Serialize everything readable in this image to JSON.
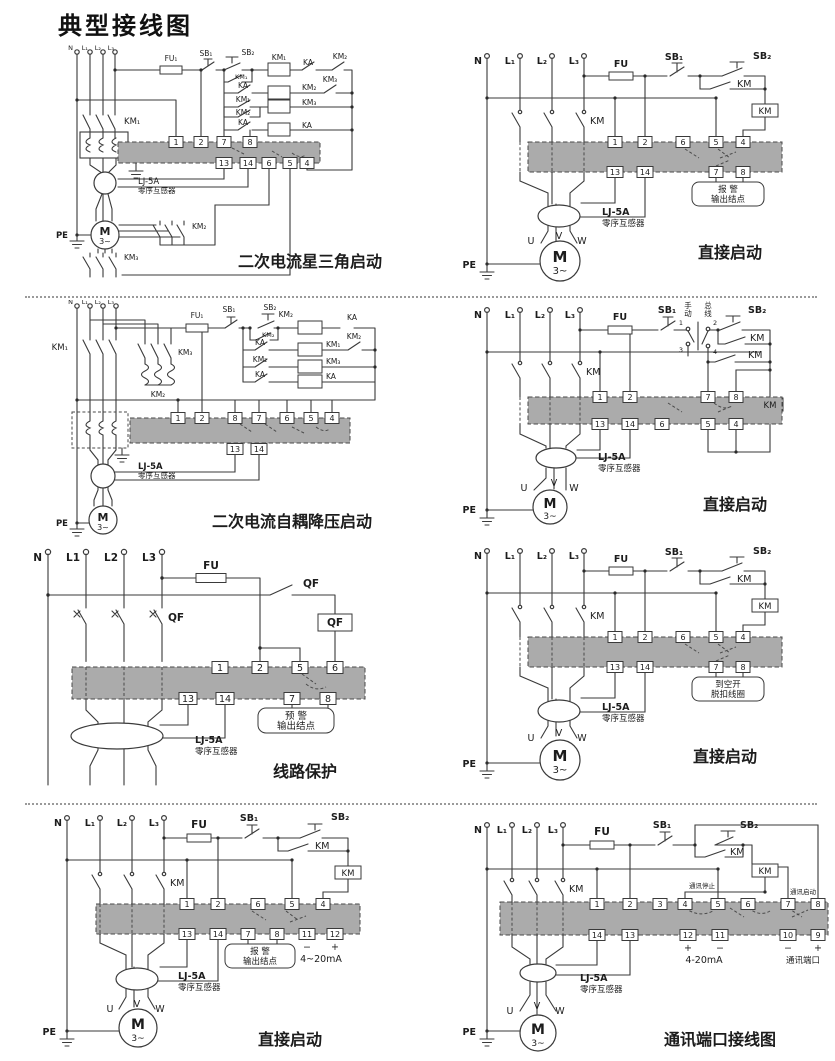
{
  "title": "典型接线图",
  "colors": {
    "relay_block": "#ababab",
    "wire": "#3a3a3a"
  },
  "d0": {
    "caption": "二次电流星三角启动",
    "n": "N",
    "l1": "L₁",
    "l2": "L₂",
    "l3": "L₃",
    "fu": "FU₁",
    "sb1": "SB₁",
    "sb2": "SB₂",
    "km1_coil": "KM₁",
    "ka_nc": "KA",
    "km2_nc": "KM₂",
    "km1_hold": "KM₁",
    "ka_no": "KA",
    "km2_coil": "KM₂",
    "km3_nc": "KM₃",
    "km1_no": "KM₁",
    "km2_no": "KM₂",
    "km3_coil": "KM₃",
    "ka2": "KA",
    "ka_coil": "KA",
    "km_main": "KM₁",
    "km2_main": "KM₂",
    "km3_main": "KM₃",
    "t_top": [
      "1",
      "2",
      "7",
      "8"
    ],
    "t_bot": [
      "13",
      "14",
      "6",
      "5",
      "4"
    ],
    "ct_name": "LJ-5A",
    "ct_desc": "零序互感器",
    "pe": "PE",
    "motor": "M",
    "motor_sub": "3~"
  },
  "d1": {
    "caption": "直接启动",
    "n": "N",
    "l1": "L₁",
    "l2": "L₂",
    "l3": "L₃",
    "fu": "FU",
    "sb1": "SB₁",
    "sb2": "SB₂",
    "km_hold": "KM",
    "km_coil": "KM",
    "km_main": "KM",
    "t_top": [
      "1",
      "2",
      "6",
      "5",
      "4"
    ],
    "t_bot": [
      "13",
      "14",
      "7",
      "8"
    ],
    "out1": "报 警",
    "out2": "输出结点",
    "ct_name": "LJ-5A",
    "ct_desc": "零序互感器",
    "u": "U",
    "v": "V",
    "w": "W",
    "pe": "PE",
    "motor": "M",
    "motor_sub": "3~"
  },
  "d2": {
    "caption": "二次电流自耦降压启动",
    "n": "N",
    "l1": "L₁",
    "l2": "L₂",
    "l3": "L₃",
    "km1_main": "KM₁",
    "km3_main": "KM₃",
    "km2_auto": "KM₂",
    "fu": "FU₁",
    "sb1": "SB₁",
    "sb2": "SB₂",
    "km2_coil": "KM₂",
    "ka_nc": "KA",
    "km2_hold": "KM₂",
    "ka_no": "KA",
    "km1_coil": "KM₁",
    "km2_nc": "KM₂",
    "km2_no": "KM₂",
    "km3_coil": "KM₃",
    "ka2": "KA",
    "ka_coil": "KA",
    "t_top": [
      "1",
      "2",
      "8",
      "7",
      "6",
      "5",
      "4"
    ],
    "t_bot": [
      "13",
      "14"
    ],
    "ct_name": "LJ-5A",
    "ct_desc": "零序互感器",
    "pe": "PE",
    "motor": "M",
    "motor_sub": "3~"
  },
  "d3": {
    "caption": "直接启动",
    "n": "N",
    "l1": "L₁",
    "l2": "L₂",
    "l3": "L₃",
    "fu": "FU",
    "sb1": "SB₁",
    "sb2": "SB₂",
    "manual_1": "手",
    "manual_2": "动",
    "bus_1": "总",
    "bus_2": "线",
    "s1": "1",
    "s3": "3",
    "s2": "2",
    "s4": "4",
    "km_hold": "KM",
    "km_no": "KM",
    "km_coil": "KM",
    "km_main": "KM",
    "t_top": [
      "1",
      "2",
      "7",
      "8"
    ],
    "t_bot": [
      "13",
      "14",
      "6",
      "5",
      "4"
    ],
    "ct_name": "LJ-5A",
    "ct_desc": "零序互感器",
    "u": "U",
    "v": "V",
    "w": "W",
    "pe": "PE",
    "motor": "M",
    "motor_sub": "3~"
  },
  "d4": {
    "caption": "线路保护",
    "n": "N",
    "l1": "L1",
    "l2": "L2",
    "l3": "L3",
    "fu": "FU",
    "qf_sw": "QF",
    "qf_box": "QF",
    "qf_main": "QF",
    "t_top": [
      "1",
      "2",
      "5",
      "6"
    ],
    "t_bot": [
      "13",
      "14",
      "7",
      "8"
    ],
    "out1": "预 警",
    "out2": "输出结点",
    "ct_name": "LJ-5A",
    "ct_desc": "零序互感器"
  },
  "d5": {
    "caption": "直接启动",
    "n": "N",
    "l1": "L₁",
    "l2": "L₂",
    "l3": "L₃",
    "fu": "FU",
    "sb1": "SB₁",
    "sb2": "SB₂",
    "km_hold": "KM",
    "km_coil": "KM",
    "km_main": "KM",
    "t_top": [
      "1",
      "2",
      "6",
      "5",
      "4"
    ],
    "t_bot": [
      "13",
      "14",
      "7",
      "8"
    ],
    "out1": "到空开",
    "out2": "脱扣线圈",
    "ct_name": "LJ-5A",
    "ct_desc": "零序互感器",
    "u": "U",
    "v": "V",
    "w": "W",
    "pe": "PE",
    "motor": "M",
    "motor_sub": "3~"
  },
  "d6": {
    "caption": "直接启动",
    "n": "N",
    "l1": "L₁",
    "l2": "L₂",
    "l3": "L₃",
    "fu": "FU",
    "sb1": "SB₁",
    "sb2": "SB₂",
    "km_hold": "KM",
    "km_coil": "KM",
    "km_main": "KM",
    "t_top": [
      "1",
      "2",
      "6",
      "5",
      "4"
    ],
    "t_bot": [
      "13",
      "14",
      "7",
      "8",
      "11",
      "12"
    ],
    "out1": "报 警",
    "out2": "输出结点",
    "minus": "−",
    "plus": "+",
    "ma": "4~20mA",
    "ct_name": "LJ-5A",
    "ct_desc": "零序互感器",
    "u": "U",
    "v": "V",
    "w": "W",
    "pe": "PE",
    "motor": "M",
    "motor_sub": "3~"
  },
  "d7": {
    "caption": "通讯端口接线图",
    "n": "N",
    "l1": "L₁",
    "l2": "L₂",
    "l3": "L₃",
    "fu": "FU",
    "sb1": "SB₁",
    "sb2": "SB₂",
    "km_hold": "KM",
    "km_coil": "KM",
    "km_main": "KM",
    "comm_stop": "通讯停止",
    "comm_start": "通讯启动",
    "t_top": [
      "1",
      "2",
      "3",
      "4",
      "5",
      "6",
      "7",
      "8"
    ],
    "t_bot": [
      "14",
      "13",
      "12",
      "11",
      "10",
      "9"
    ],
    "p12": "+",
    "m11": "−",
    "ma": "4-20mA",
    "m10": "−",
    "p9": "+",
    "cp": "通讯端口",
    "ct_name": "LJ-5A",
    "ct_desc": "零序互感器",
    "u": "U",
    "v": "V",
    "w": "W",
    "pe": "PE",
    "motor": "M",
    "motor_sub": "3~"
  }
}
